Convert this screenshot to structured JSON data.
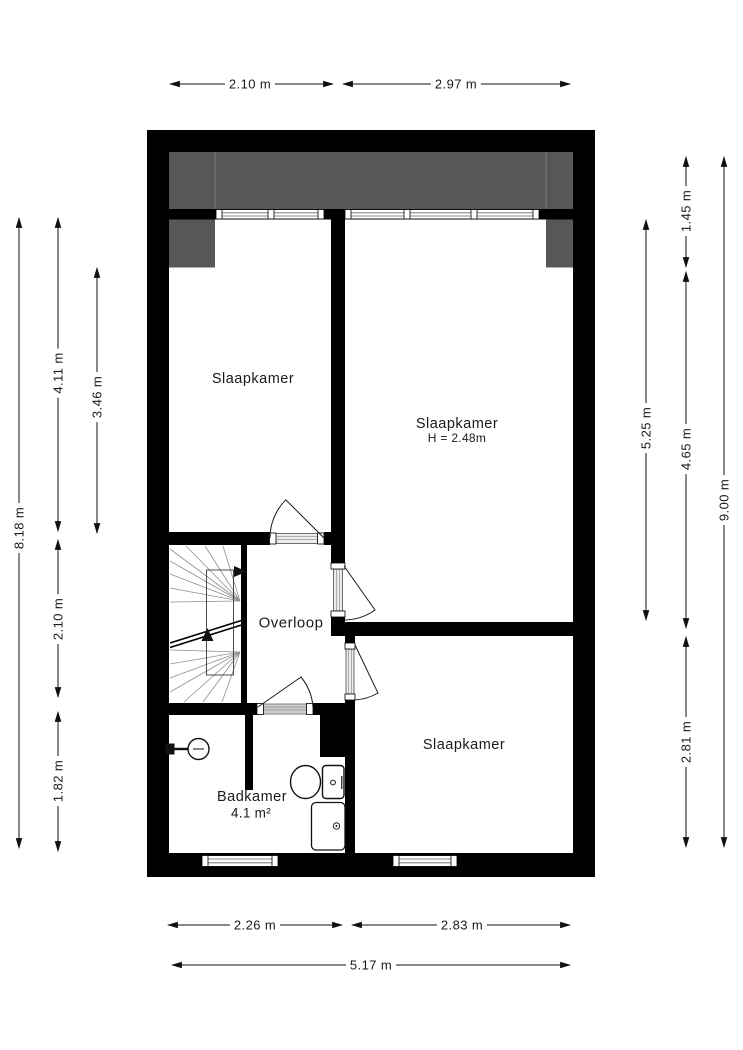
{
  "plan": {
    "rooms": [
      {
        "name": "Slaapkamer"
      },
      {
        "name": "Slaapkamer",
        "height_note": "H = 2.48m"
      },
      {
        "name": "Overloop"
      },
      {
        "name": "Badkamer",
        "area": "4.1 m²"
      },
      {
        "name": "Slaapkamer"
      }
    ],
    "dimensions": {
      "top": [
        "2.10 m",
        "2.97 m"
      ],
      "bottom": [
        "2.26 m",
        "2.83 m",
        "5.17 m"
      ],
      "left": [
        "8.18 m",
        "4.11 m",
        "3.46 m",
        "2.10 m",
        "1.82 m"
      ],
      "right": [
        "1.45 m",
        "5.25 m",
        "4.65 m",
        "2.81 m",
        "9.00 m"
      ]
    },
    "colors": {
      "wall": "#000000",
      "roof_area": "#575757",
      "background": "#ffffff"
    }
  }
}
